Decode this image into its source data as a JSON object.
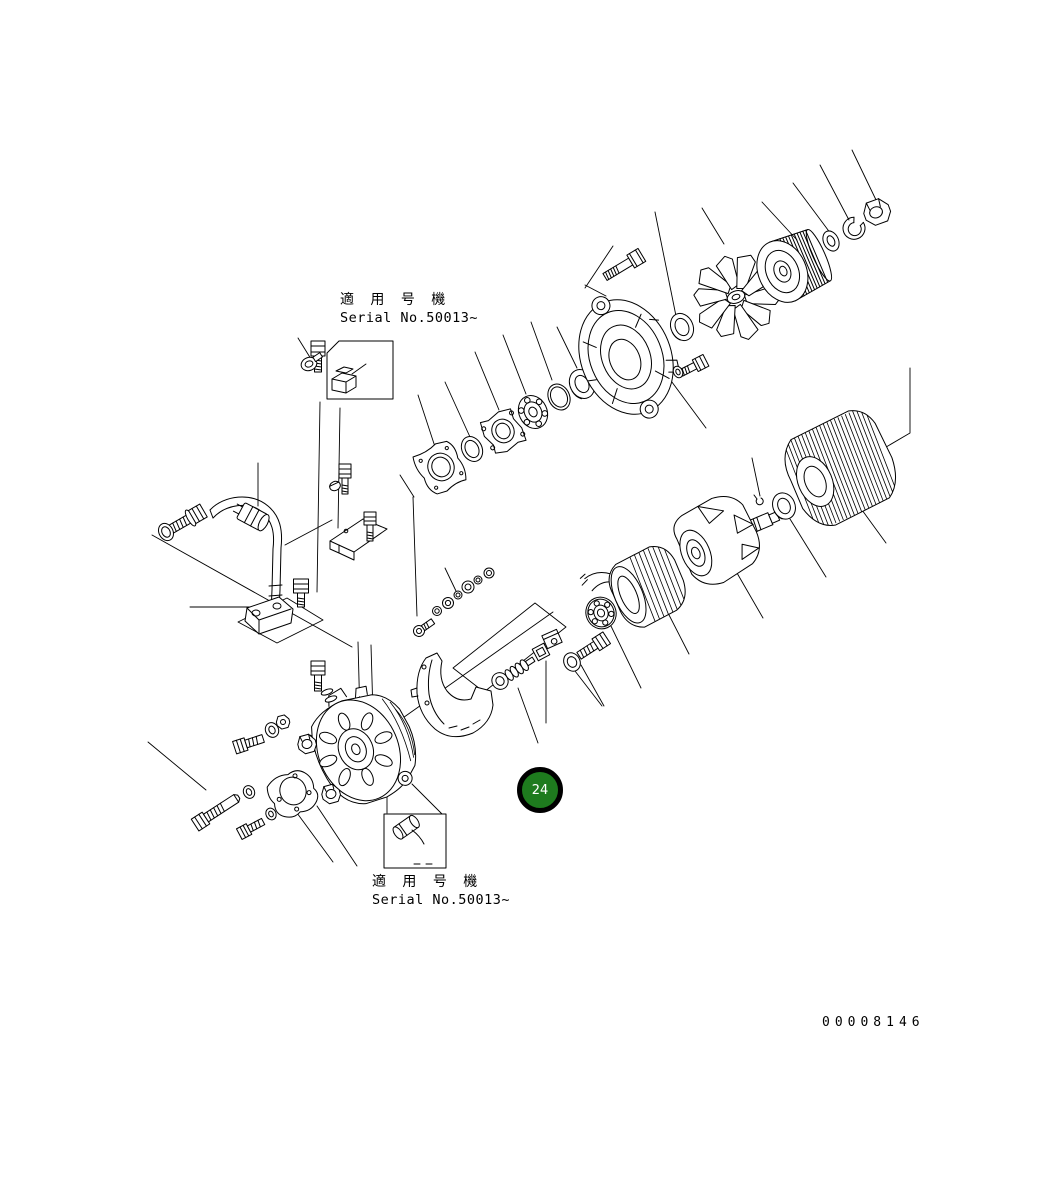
{
  "diagram": {
    "type": "exploded-parts-diagram",
    "callout_badge": {
      "number": "24"
    },
    "labels": {
      "top_applicability": {
        "japanese": "適 用 号 機",
        "serial": "Serial No.50013~"
      },
      "bottom_applicability": {
        "japanese": "適 用 号 機",
        "serial": "Serial No.50013~"
      }
    },
    "drawing_number": "00008146",
    "colors": {
      "background": "#ffffff",
      "line_art": "#000000",
      "badge_fill": "#1e7b1e",
      "badge_ring": "#000000",
      "badge_text": "#ffffff"
    }
  }
}
